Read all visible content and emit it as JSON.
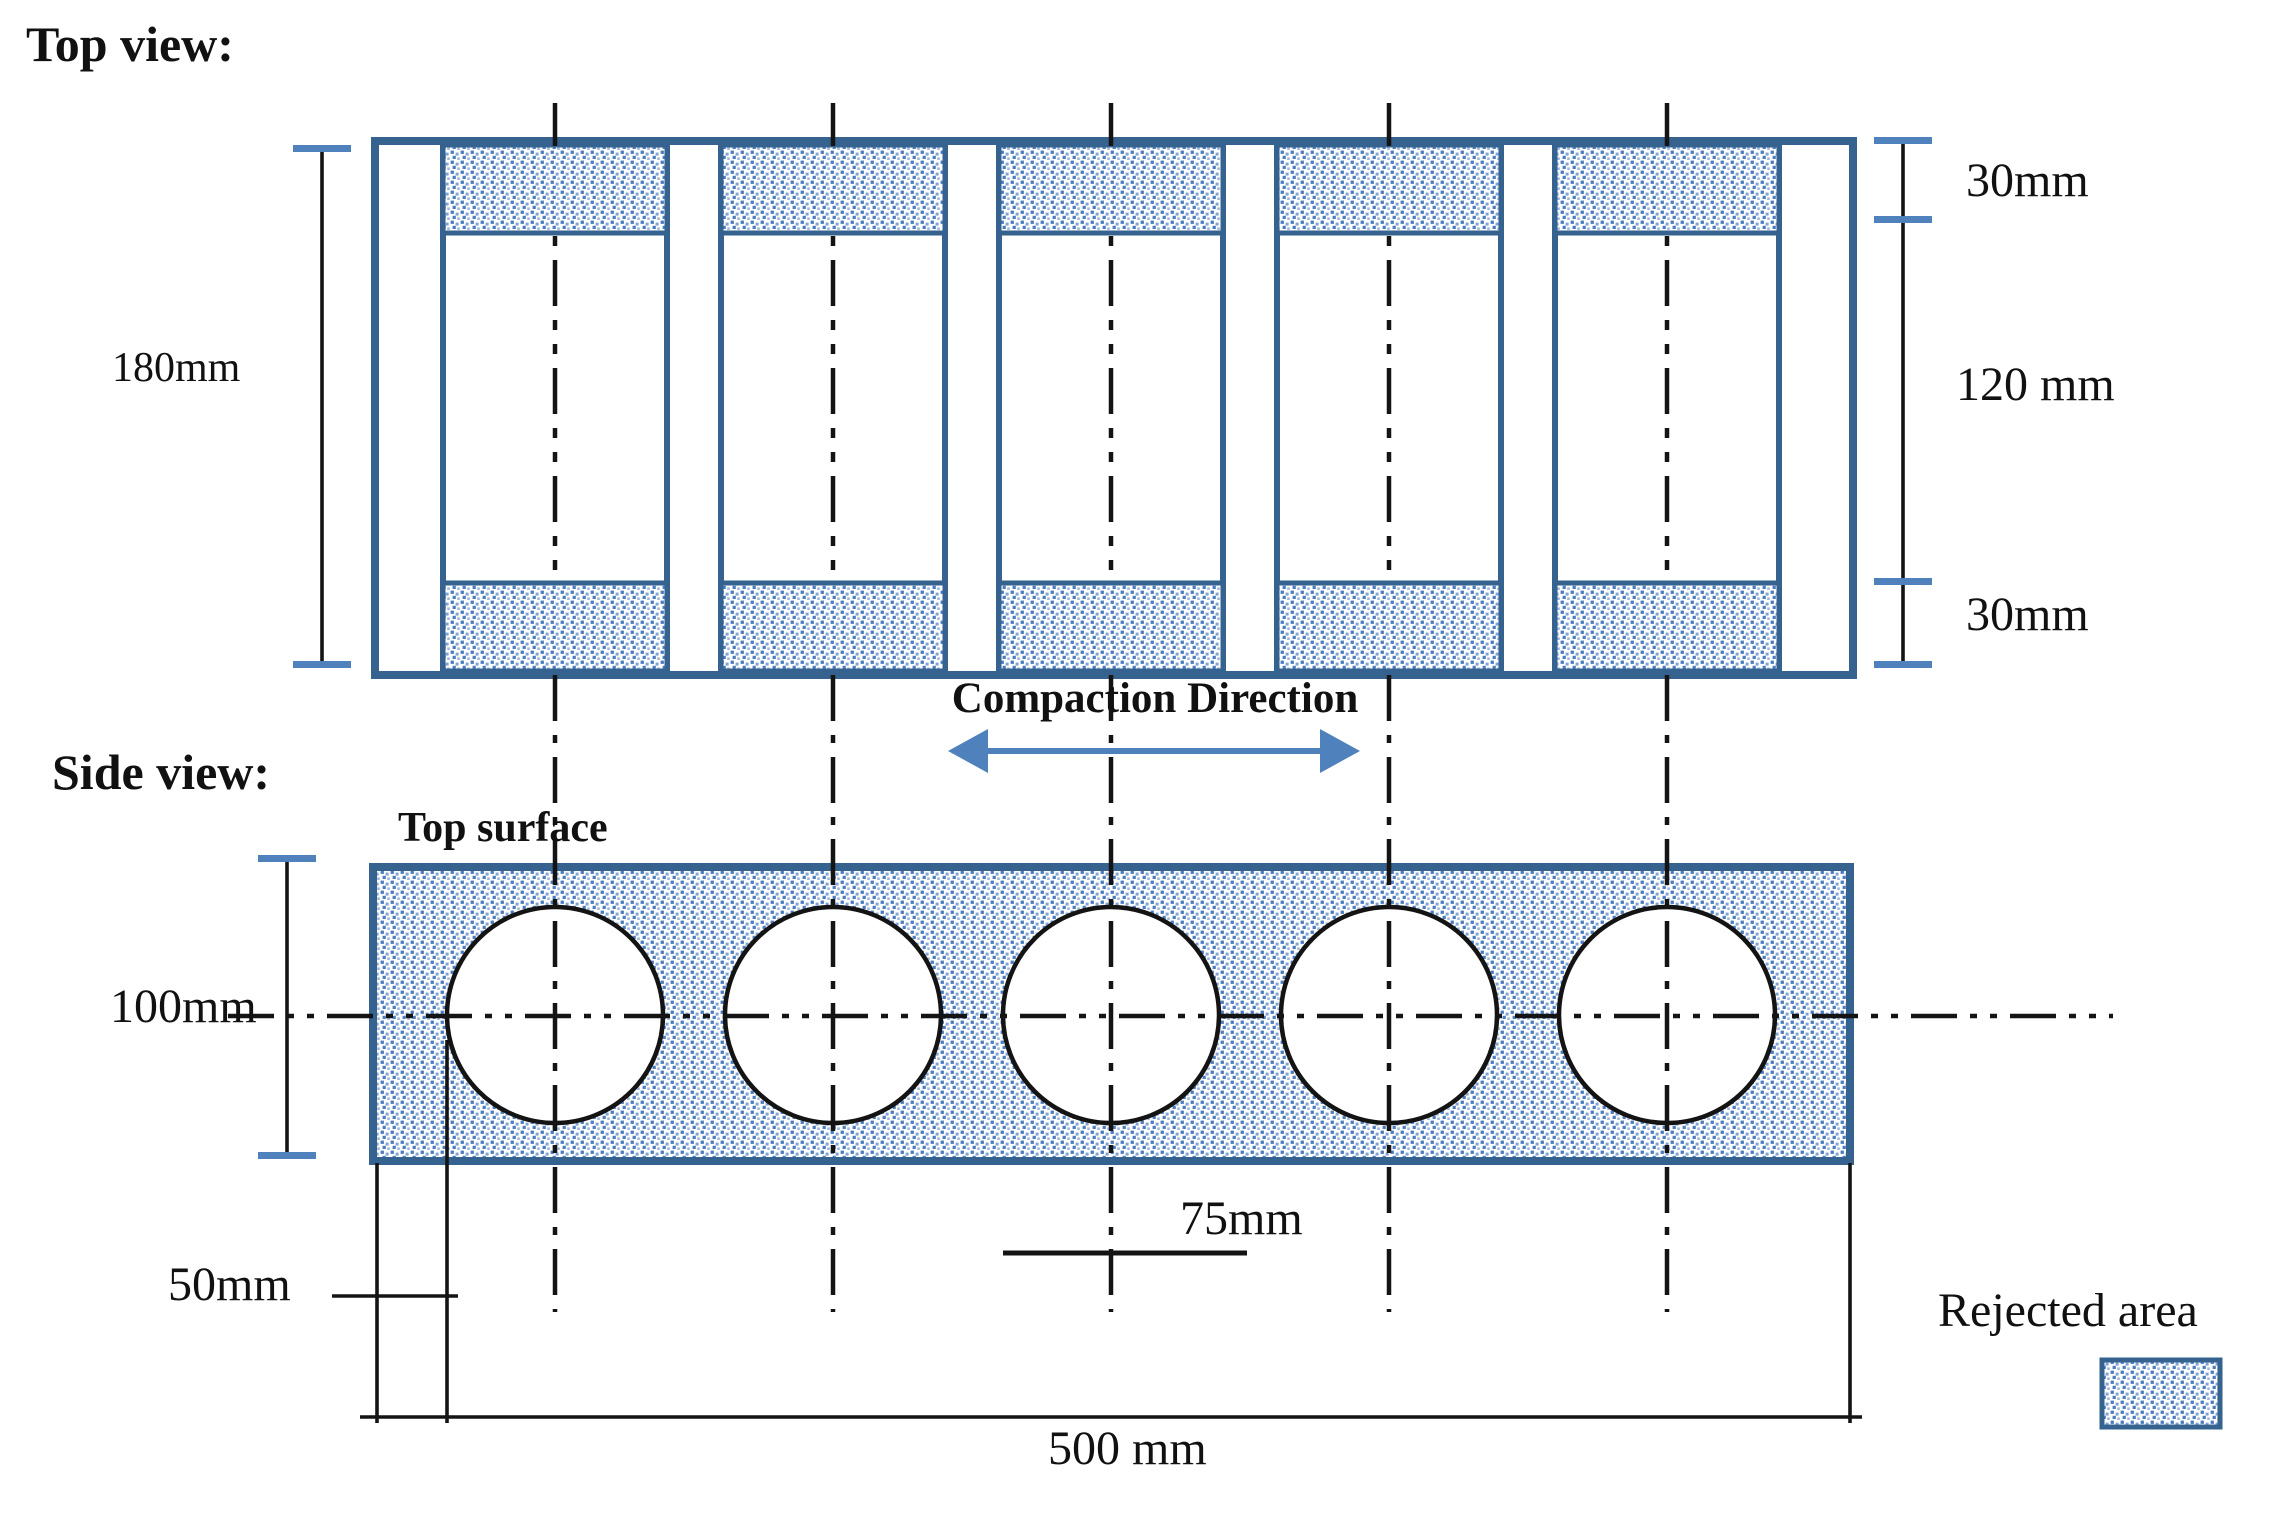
{
  "figure": {
    "top_view": {
      "title": "Top view:",
      "dims": {
        "height_total": "180mm",
        "band_top": "30mm",
        "middle": "120 mm",
        "band_bottom": "30mm"
      }
    },
    "compaction": {
      "label": "Compaction Direction",
      "arrow_icon": "double-headed-horizontal-arrow"
    },
    "side_view": {
      "title": "Side view:",
      "top_surface_label": "Top surface",
      "dims": {
        "height": "100mm",
        "edge_offset": "50mm",
        "core_diameter": "75mm",
        "total_length": "500 mm"
      }
    },
    "legend": {
      "label": "Rejected area",
      "swatch": "stipple-pattern-swatch"
    },
    "colors": {
      "outline_blue": "#36628F",
      "stipple_dot": "#4A7CBF",
      "stipple_dot_light": "#7FA3D4",
      "accent_blue": "#4F81BD",
      "ink": "#111111"
    }
  }
}
